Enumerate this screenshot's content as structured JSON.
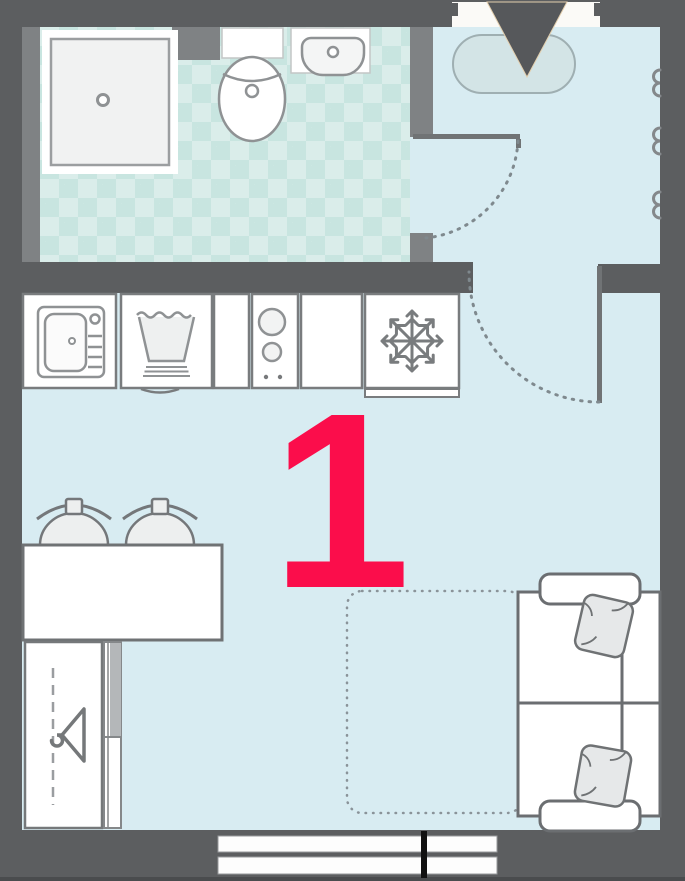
{
  "floorplan": {
    "unit_label": "1",
    "colors": {
      "wall": "#5C5E60",
      "wall_inner": "#7F8284",
      "floor": "#D8ECF2",
      "bath_tile_base": "#DAEDEA",
      "bath_tile_diamond": "#C8E5E0",
      "fixture_outline": "#8F9294",
      "furniture_outline": "#6F7274",
      "accent": "#FB0D4B",
      "doormat_fill": "#D3E4E6",
      "window_mullion": "#111111"
    },
    "rooms": {
      "bathroom": {
        "fixtures": [
          "shower-icon",
          "toilet-icon",
          "washbasin-icon"
        ]
      },
      "hall": {
        "fixtures": [
          "entrance-arrow-icon",
          "doormat",
          "wall-outlet-icon",
          "door-swing-arc"
        ]
      },
      "kitchen": {
        "fixtures": [
          "kitchen-sink-icon",
          "washing-machine-icon",
          "cooktop-icon",
          "refrigerator-snowflake-icon"
        ]
      },
      "living_room": {
        "fixtures": [
          "dining-table",
          "chair-icon",
          "wardrobe-hanger-icon",
          "sofa",
          "pillow-icon",
          "sofa-bed-dotted-outline",
          "window"
        ]
      }
    }
  }
}
